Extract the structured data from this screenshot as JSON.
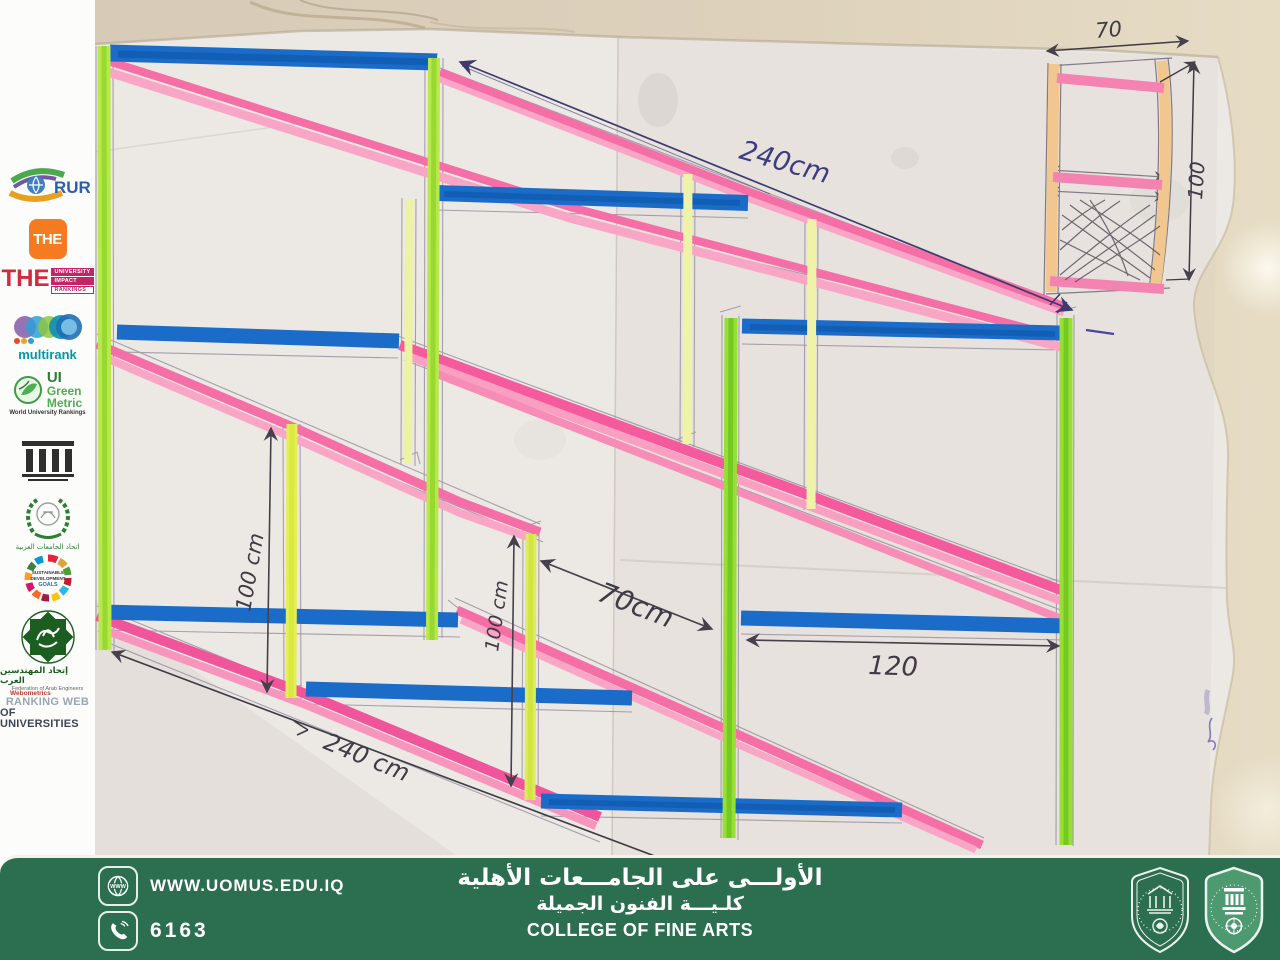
{
  "sidebar": {
    "logos": {
      "rur": {
        "label": "RUR"
      },
      "the": {
        "label": "THE"
      },
      "impact": {
        "the": "THE",
        "lines": [
          "UNIVERSITY",
          "IMPACT",
          "RANKINGS"
        ]
      },
      "multirank": {
        "label": "multirank"
      },
      "greenmetric": {
        "ui": "UI",
        "green": "Green",
        "metric": "Metric",
        "tagline": "World University Rankings"
      },
      "aaru": {
        "label": "اتحاد الجامعات العربية"
      },
      "sdg": {
        "line1": "SUSTAINABLE",
        "line2": "DEVELOPMENT",
        "line3": "GOALS"
      },
      "fae": {
        "arabic": "إتحاد المهندسين العرب",
        "english": "Federation of Arab Engineers"
      },
      "webometrics": {
        "brand": "Webometrics",
        "line1": "RANKING WEB",
        "line2": "OF UNIVERSITIES"
      }
    }
  },
  "drawing": {
    "description": "hand-drawn perspective sketch of a multi-shelf display stand",
    "dims": {
      "top_length": "240cm",
      "left_height": "100 cm",
      "mid_height": "100 cm",
      "depth": "70cm",
      "bay_width": "120",
      "bottom_length": "240 cm",
      "detail_width": "70",
      "detail_height": "100"
    },
    "colors": {
      "rail_pink": "#f56ea6",
      "shelf_blue": "#1a6cc8",
      "post_green": "#a8e13c",
      "detail_tan": "#f1c78f",
      "ink": "#3d3b6e",
      "pencil": "#4a4550"
    }
  },
  "banner": {
    "website": "WWW.UOMUS.EDU.IQ",
    "phone": "6163",
    "arabic_line1": "الأولـــى على الجامـــعات الأهلية",
    "arabic_line2": "كلـيـــة الفنون الجميلة",
    "english_line": "COLLEGE OF FINE ARTS",
    "green": "#2b6e50"
  }
}
